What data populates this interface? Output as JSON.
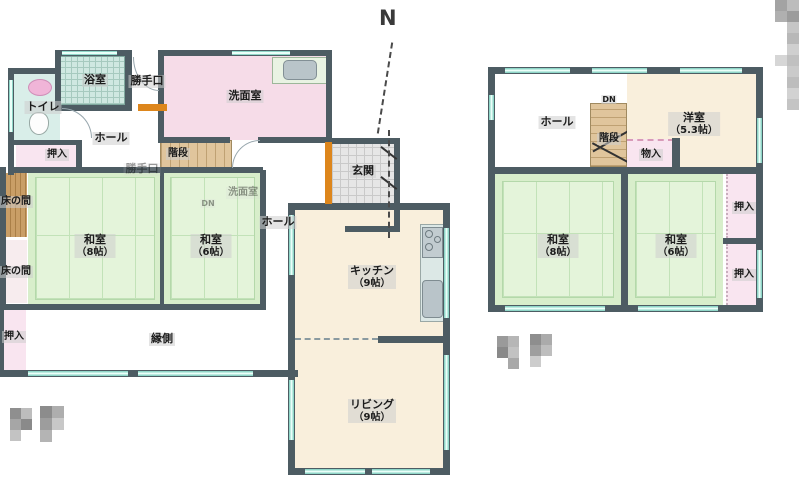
{
  "compass": {
    "north": "N"
  },
  "floor1": {
    "toilet": "トイレ",
    "bath": "浴室",
    "back_door": "勝手口",
    "washroom": "洗面室",
    "hall_upper": "ホール",
    "closet_upper": "押入",
    "stairs": "階段",
    "entrance": "玄関",
    "tokonoma_1": "床の間",
    "tokonoma_2": "床の間",
    "washitsu_8": {
      "name": "和室",
      "size": "（8帖）"
    },
    "washitsu_6": {
      "name": "和室",
      "size": "（6帖）"
    },
    "hall_center": "ホール",
    "kitchen": {
      "name": "キッチン",
      "size": "（9帖）"
    },
    "living": {
      "name": "リビング",
      "size": "（9帖）"
    },
    "engawa": "縁側",
    "closet_lower": "押入",
    "ghosts": {
      "back_door": "勝手口",
      "washroom": "洗面室",
      "dn": "DN"
    }
  },
  "floor2": {
    "hall": "ホール",
    "dn": "DN",
    "stairs": "階段",
    "storage": "物入",
    "youshitsu": {
      "name": "洋室",
      "size": "（5.3帖）"
    },
    "washitsu_8": {
      "name": "和室",
      "size": "（8帖）"
    },
    "washitsu_6": {
      "name": "和室",
      "size": "（6帖）"
    },
    "closet_top": "押入",
    "closet_bottom": "押入"
  },
  "colors": {
    "wall": "#4d5c63",
    "tatami_green": "#d8eecb",
    "room_pink": "#f6dce8",
    "room_cream": "#f9efdc",
    "stairs_tan": "#e0c59c",
    "window_teal": "#8fd6c8",
    "threshold_orange": "#dd861c",
    "wood_brown": "#c99e66"
  }
}
